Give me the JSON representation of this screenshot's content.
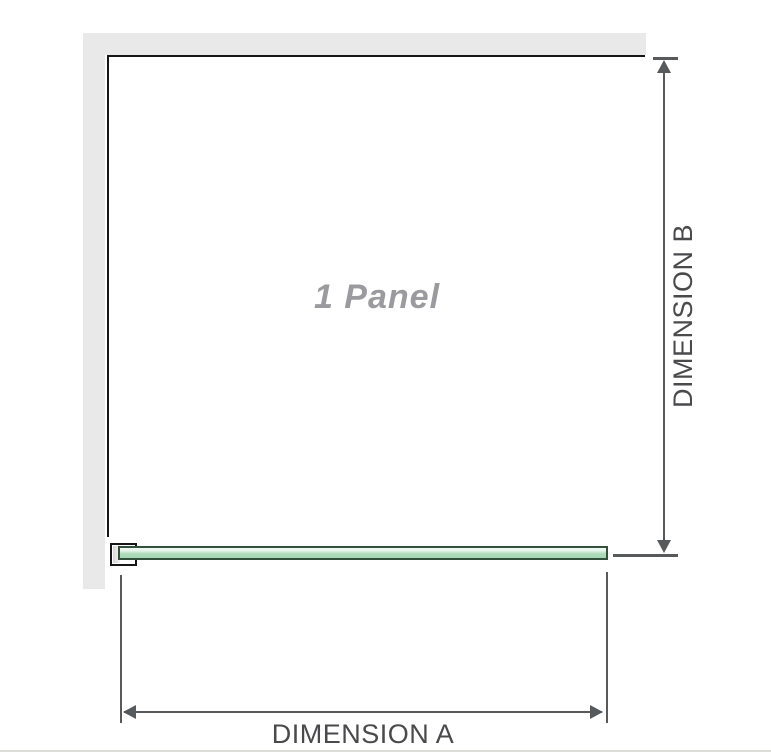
{
  "diagram": {
    "panel_label": "1 Panel",
    "dimension_a_label": "DIMENSION A",
    "dimension_b_label": "DIMENSION B"
  },
  "colors": {
    "wall_gray": "#e9e9e9",
    "panel_outline_black": "#161616",
    "glass_green_fill": "#a6d6b4",
    "glass_green_highlight": "#f1faf3",
    "glass_border_green": "#32503c",
    "dimension_gray": "#58595b",
    "label_text_gray": "#4a4a4c",
    "panel_label_gray": "#9b9b9f",
    "baseline_gray": "#dcdcd8"
  }
}
